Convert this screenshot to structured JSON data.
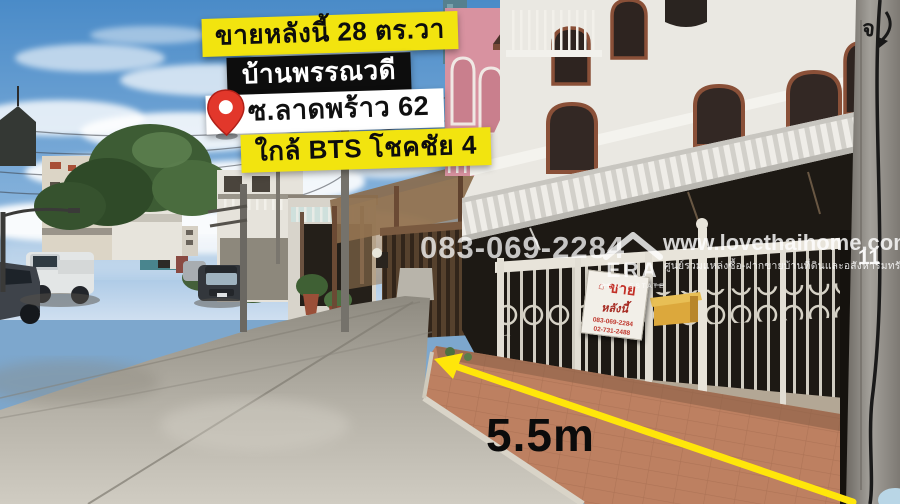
{
  "listing": {
    "headline": "ขายหลังนี้ 28 ตร.วา",
    "project_name": "บ้านพรรณวดี",
    "location": "ซ.ลาดพร้าว 62",
    "landmark": "ใกล้ BTS โชคชัย 4"
  },
  "watermark": {
    "phone": "083-069-2284",
    "website": "www.lovethaihome.com",
    "tagline": "ศูนย์รวมแหล่งซื้อ-ฝากขายบ้านที่ดินและอสังหาริมทรัพย์",
    "agency": "ERA",
    "agency_sub": "REAL ESTATE"
  },
  "measurement": {
    "width_label": "5.5m"
  },
  "scene": {
    "sale_sign": {
      "title": "ขาย",
      "line2": "หลังนี้",
      "phone1": "083-069-2284",
      "phone2": "02-731-2488"
    },
    "pole": {
      "painted_number": "11",
      "painted_letter": "จ"
    }
  },
  "colors": {
    "highlight_yellow": "#F2E40F",
    "label_black": "#0D0D0D",
    "label_white": "#FFFFFF",
    "pin_red": "#E2372B",
    "arrow_yellow": "#FFE60A",
    "watermark_white": "#FFFFFF"
  }
}
